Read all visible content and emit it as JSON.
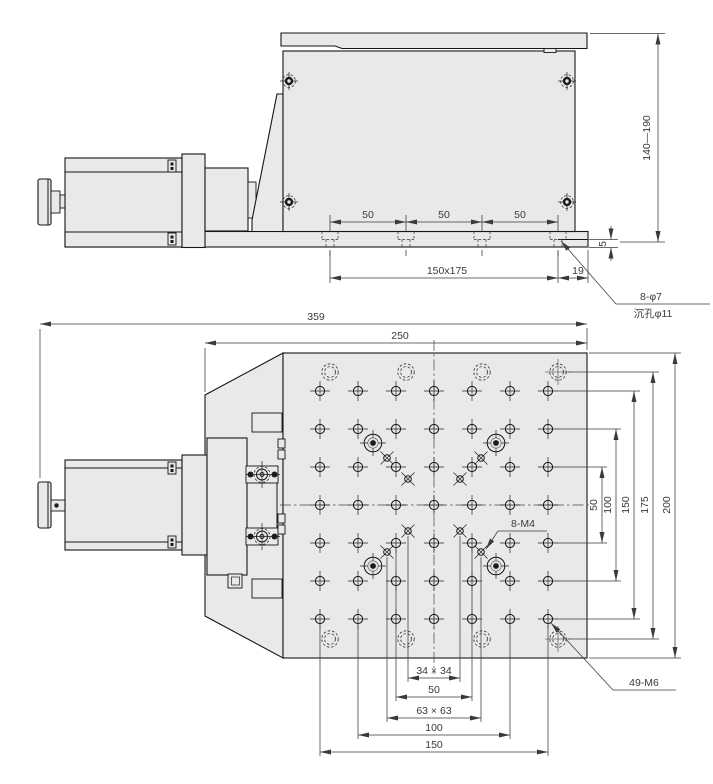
{
  "side_view": {
    "dims": {
      "seg_a": "50",
      "seg_b": "50",
      "seg_c": "50",
      "base_pattern": "150x175",
      "edge_offset": "19",
      "lip_thickness": "5",
      "height_range": "140—190"
    },
    "callout": {
      "holes": "8-φ7",
      "counterbore": "沉孔φ11"
    }
  },
  "plan_view": {
    "dims": {
      "overall_length": "359",
      "top_width": "250",
      "rows_50": "50",
      "rows_100": "100",
      "rows_150": "150",
      "cbore_175": "175",
      "depth_200": "200",
      "m4_inner": "34 × 34",
      "cols_50": "50",
      "m4_outer": "63 × 63",
      "cols_100": "100",
      "cols_150": "150"
    },
    "callouts": {
      "grid": "49-M6",
      "diagonal": "8-M4"
    }
  }
}
